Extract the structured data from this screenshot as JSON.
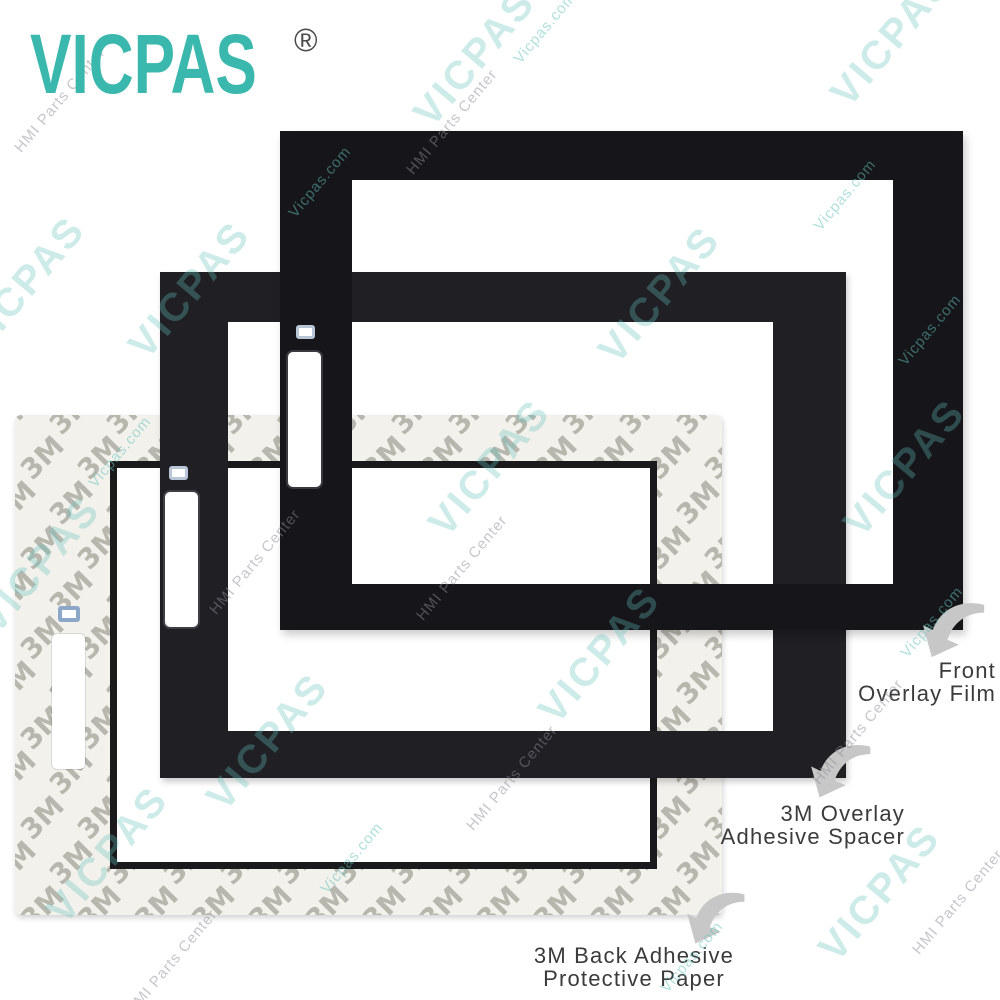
{
  "brand": {
    "logo_text": "VICPAS",
    "registered_mark": "®"
  },
  "product_layers": {
    "front_film": {
      "label_line1": "Front",
      "label_line2": "Overlay Film"
    },
    "adhesive_spacer": {
      "label_line1": "3M Overlay",
      "label_line2": "Adhesive Spacer"
    },
    "back_paper": {
      "label_line1": "3M Back Adhesive",
      "label_line2": "Protective Paper",
      "pattern_glyph": "3M"
    }
  },
  "watermark": {
    "brand_text": "VICPAS",
    "site_text": "Vicpas.com",
    "center_text": "HMI Parts Center",
    "big_positions": [
      {
        "x": 25,
        "y": 285
      },
      {
        "x": 190,
        "y": 290
      },
      {
        "x": 475,
        "y": 58
      },
      {
        "x": 660,
        "y": 295
      },
      {
        "x": 892,
        "y": 38
      },
      {
        "x": 490,
        "y": 468
      },
      {
        "x": 905,
        "y": 468
      },
      {
        "x": 108,
        "y": 855
      },
      {
        "x": 600,
        "y": 655
      },
      {
        "x": 880,
        "y": 893
      },
      {
        "x": 268,
        "y": 742
      },
      {
        "x": 40,
        "y": 565
      }
    ],
    "small_positions": [
      {
        "x": 545,
        "y": 28,
        "kind": "site"
      },
      {
        "x": 452,
        "y": 122,
        "kind": "center"
      },
      {
        "x": 60,
        "y": 100,
        "kind": "center"
      },
      {
        "x": 845,
        "y": 195,
        "kind": "site"
      },
      {
        "x": 320,
        "y": 182,
        "kind": "site"
      },
      {
        "x": 120,
        "y": 452,
        "kind": "site"
      },
      {
        "x": 255,
        "y": 562,
        "kind": "center"
      },
      {
        "x": 462,
        "y": 568,
        "kind": "center"
      },
      {
        "x": 930,
        "y": 330,
        "kind": "site"
      },
      {
        "x": 512,
        "y": 778,
        "kind": "center"
      },
      {
        "x": 352,
        "y": 858,
        "kind": "site"
      },
      {
        "x": 932,
        "y": 622,
        "kind": "site"
      },
      {
        "x": 858,
        "y": 732,
        "kind": "center"
      },
      {
        "x": 172,
        "y": 962,
        "kind": "center"
      },
      {
        "x": 692,
        "y": 957,
        "kind": "site"
      },
      {
        "x": 958,
        "y": 902,
        "kind": "center"
      }
    ]
  },
  "colors": {
    "logo_teal": "#3bb8ae",
    "film_black": "#16161a",
    "spacer_black": "#1f1f24",
    "paper_bg": "#f2f1ec",
    "pattern_gray": "#949387",
    "label_gray": "#3b3b3b",
    "arrow_gray": "#c7c7c7",
    "watermark_teal": "#62c2bb"
  }
}
